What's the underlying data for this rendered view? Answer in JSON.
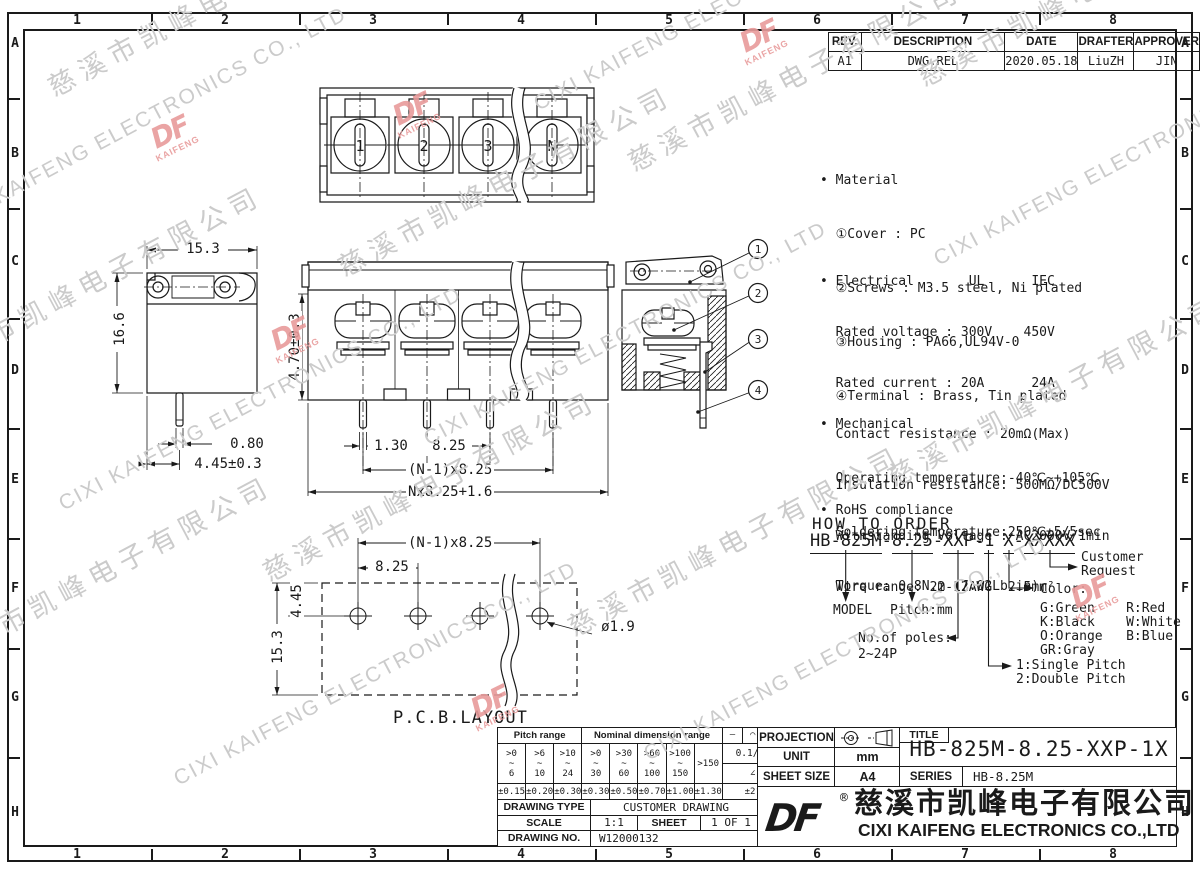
{
  "border": {
    "cols": [
      "1",
      "2",
      "3",
      "4",
      "5",
      "6",
      "7",
      "8"
    ],
    "rows": [
      "A",
      "B",
      "C",
      "D",
      "E",
      "F",
      "G",
      "H"
    ]
  },
  "rev_table": {
    "headers": [
      "REV.",
      "DESCRIPTION",
      "DATE",
      "DRAFTER",
      "APPROVER"
    ],
    "values": [
      "A1",
      "DWG.REL",
      "2020.05.18",
      "LiuZH",
      "JIN"
    ]
  },
  "notes": {
    "material": {
      "l0": "• Material",
      "l1": "  ①Cover : PC",
      "l2": "  ②Screws : M3.5 steel, Ni plated",
      "l3": "  ③Housing : PA66,UL94V-0",
      "l4": "  ④Terminal : Brass, Tin plated"
    },
    "electrical": {
      "l0": "• Electrical       UL      IEC",
      "l1": "  Rated voltage : 300V    450V",
      "l2": "  Rated current : 20A      24A",
      "l3": "  Contact resistance : 20mΩ(Max)",
      "l4": "  Insulation resistance: 500MΩ/DC500V",
      "l5": "  Withstanding Voltage : AC2000V/1min",
      "l6": "  Wire range: 22-12AWG  2.5mm²"
    },
    "mechanical": {
      "l0": "• Mechanical",
      "l1": "  Operating temperature:-40℃~+105℃",
      "l2": "  Soldering temperature:250℃±5/5sec",
      "l3": "  Torque: 0.8N.m (7.02Lb.in)"
    },
    "rohs": {
      "l0": "• RoHS compliance"
    }
  },
  "order": {
    "heading": "HOW TO ORDER",
    "sep": "-",
    "segments": [
      "HB-825M",
      "8.25",
      "XXP",
      "1",
      "X",
      "XXXXX"
    ],
    "labels": {
      "model": "MODEL",
      "pitch": "Pitch:mm",
      "poles_1": "No.of poles:",
      "poles_2": "2~24P",
      "pitch_type_1": "1:Single Pitch",
      "pitch_type_2": "2:Double Pitch",
      "color_title": "Color:",
      "color_1": "G:Green    R:Red",
      "color_2": "K:Black    W:White",
      "color_3": "O:Orange   B:Blue",
      "color_4": "GR:Gray",
      "customer_1": "Customer",
      "customer_2": "Request"
    }
  },
  "dims": {
    "side": {
      "width": "15.3",
      "height": "16.6",
      "pin_w": "0.80",
      "pin_off": "4.45±0.3"
    },
    "front": {
      "pin_len": "4.70±0.3",
      "d1": "1.30",
      "pitch": "8.25",
      "span": "(N-1)x8.25",
      "total": "Nx8.25+1.6"
    },
    "pcb": {
      "span": "(N-1)x8.25",
      "pitch": "8.25",
      "row": "4.45",
      "height": "15.3",
      "hole": "ø1.9",
      "label": "P.C.B.LAYOUT"
    }
  },
  "top_view_labels": [
    "1",
    "2",
    "3",
    "N"
  ],
  "section_balloons": [
    "1",
    "2",
    "3",
    "4"
  ],
  "tol_table": {
    "pitch_header": "Pitch range",
    "nominal_header": "Nominal dimension range",
    "sym_1": "—",
    "sym_2": "⌒",
    "sym_3": "□",
    "ranges": [
      ">0\n~\n6",
      ">6\n~\n10",
      ">10\n~\n24",
      ">0\n~\n30",
      ">30\n~\n60",
      ">60\n~\n100",
      ">100\n~\n150",
      ">150"
    ],
    "ratio": "0.1/10",
    "angle_symbol": "∠",
    "tolerances": [
      "±0.15",
      "±0.20",
      "±0.30",
      "±0.30",
      "±0.50",
      "±0.70",
      "±1.00",
      "±1.30",
      "±2°"
    ]
  },
  "title_block": {
    "projection_label": "PROJECTION",
    "unit_label": "UNIT",
    "unit": "mm",
    "sheet_size_label": "SHEET SIZE",
    "sheet_size": "A4",
    "title_label": "TITLE",
    "title": "HB-825M-8.25-XXP-1X",
    "series_label": "SERIES",
    "series": "HB-8.25M",
    "drawing_type_label": "DRAWING TYPE",
    "drawing_type": "CUSTOMER DRAWING",
    "scale_label": "SCALE",
    "scale": "1:1",
    "sheet_label": "SHEET",
    "sheet": "1 OF 1",
    "drawing_no_label": "DRAWING NO.",
    "drawing_no": "W12000132"
  },
  "company": {
    "logo": "DF",
    "reg": "®",
    "name_cn": "慈溪市凯峰电子有限公司",
    "name_en": "CIXI KAIFENG ELECTRONICS CO.,LTD"
  },
  "watermark": {
    "text_cn": "慈溪市凯峰电子有限公司",
    "text_en": "CIXI KAIFENG ELECTRONICS CO., LTD",
    "logo": "DF",
    "logo_sub": "KAIFENG"
  }
}
